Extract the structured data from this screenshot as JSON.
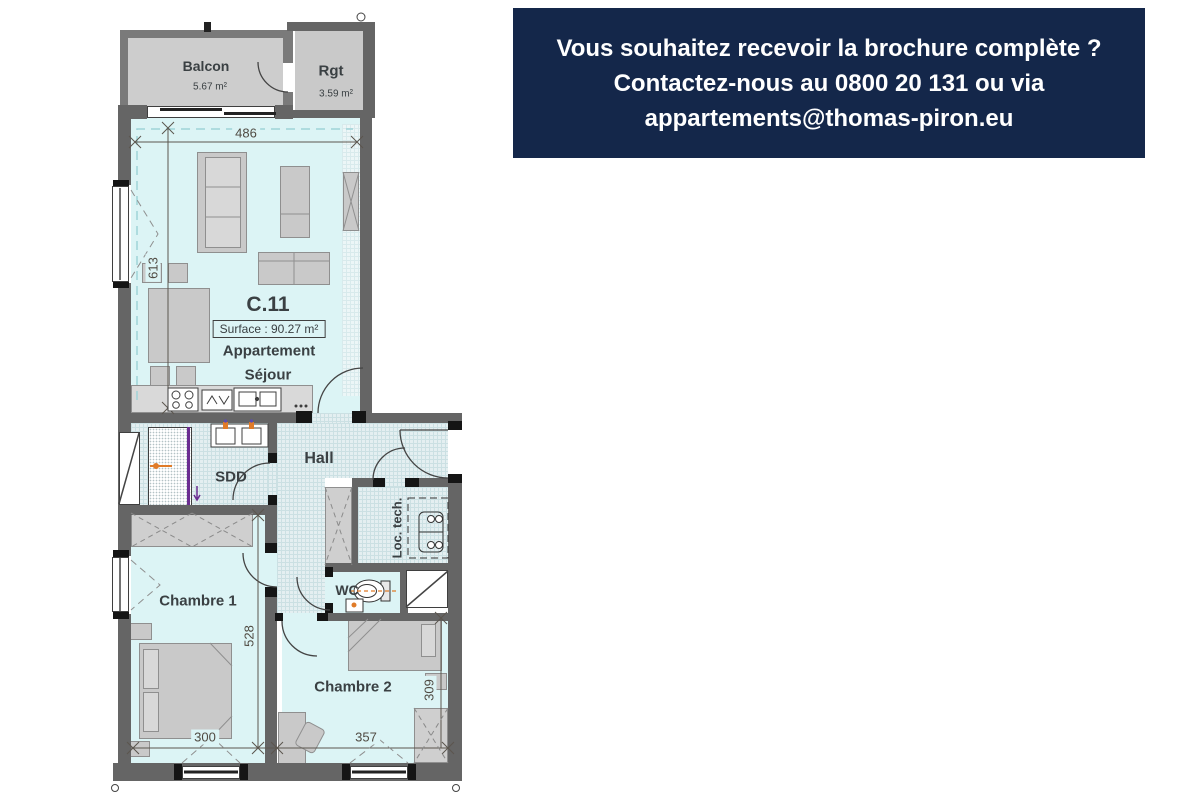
{
  "banner": {
    "bg": "#14274a",
    "text_color": "#ffffff",
    "line1": "Vous souhaitez recevoir la brochure complète ?",
    "line2": "Contactez-nous au 0800 20 131 ou via",
    "line3": "appartements@thomas-piron.eu"
  },
  "plan": {
    "unit": {
      "code": "C.11",
      "surface": "Surface : 90.27 m²",
      "type_line1": "Appartement",
      "type_line2": "Séjour"
    },
    "rooms": {
      "balcony": "Balcon",
      "balcony_area": "5.67 m²",
      "storage": "Rgt",
      "storage_area": "3.59 m²",
      "shower": "SDD",
      "hall": "Hall",
      "technical": "Loc. tech.",
      "wc": "WC",
      "bedroom1": "Chambre 1",
      "bedroom2": "Chambre 2"
    },
    "dimensions": {
      "living_width": "486",
      "living_depth": "613",
      "bedroom1_depth": "528",
      "bedroom1_width": "300",
      "bedroom2_width": "357",
      "bedroom2_depth": "309"
    },
    "colors": {
      "wall": "#656565",
      "floor": "#dcf4f5",
      "balcony_floor": "#cdcdcd",
      "accent_orange": "#e07b28",
      "accent_purple": "#6b2d91",
      "banner": "#14274a"
    }
  }
}
